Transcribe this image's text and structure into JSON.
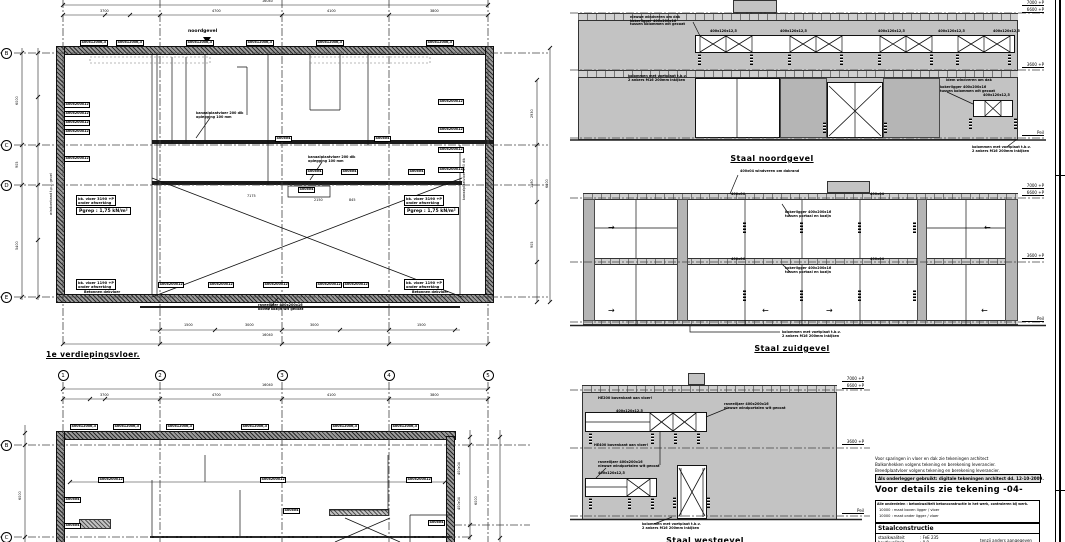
{
  "titles": {
    "plan1": "1e verdiepingsvloer.",
    "elev1": "Staal noordgevel",
    "elev2": "Staal zuidgevel",
    "elev3": "Staal westgevel",
    "marker": "noordgevel"
  },
  "grid": {
    "cols": [
      "1",
      "2",
      "3",
      "4",
      "5"
    ],
    "rows1": [
      "B",
      "C",
      "D",
      "E"
    ],
    "rows2": [
      "B",
      "C"
    ]
  },
  "levels": [
    "7000 +P",
    "6600 +P",
    "3600 +P",
    "Peil"
  ],
  "load": {
    "bk1": "bk. vloer 3190 +P",
    "bk2": "onder afwerking",
    "pgrep": "Pgrep : 1,75 kN/m²",
    "bklow": "bk. vloer 1190 +P"
  },
  "notes": {
    "line1": "Voor sparingen in vloer en dak zie tekeningen architect",
    "line2": "Balkonhekken volgens tekening en berekening leverancier.",
    "line3": "Breedplaatvloer volgens tekening en berekening leverancier.",
    "boxed": "Als onderlegger gebruikt: digitale tekeningen architect dd. 12-10-2009.",
    "detail": "Voor details zie tekening -04-",
    "legend_title": "Alle onderdelen : betonkwaliteit betonconstructie in het werk, controleren bij werk.",
    "legend1": "10000  : maat boven ligger / vloer",
    "legend2": "10000  : maat onder ligger / vloer",
    "table_title": "Staalconstructie",
    "r1_label": "staalkwaliteit",
    "r1_value": ":  FeE 235",
    "r2_label": "boutkwaliteit",
    "r2_value": ":  8.8",
    "r2_note": "tenzij anders aangegeven"
  },
  "ann": {
    "plan1": [
      {
        "t": "16040",
        "x": 262,
        "y": 0,
        "c": "dim"
      },
      {
        "t": "3700",
        "x": 100,
        "y": 10,
        "c": "dim"
      },
      {
        "t": "4700",
        "x": 212,
        "y": 10,
        "c": "dim"
      },
      {
        "t": "4100",
        "x": 327,
        "y": 10,
        "c": "dim"
      },
      {
        "t": "3800",
        "x": 430,
        "y": 10,
        "c": "dim"
      },
      {
        "t": "400x120x6,3",
        "x": 80,
        "y": 40,
        "c": "box"
      },
      {
        "t": "400x120x6,3",
        "x": 116,
        "y": 40,
        "c": "box"
      },
      {
        "t": "400x120x6,3",
        "x": 186,
        "y": 40,
        "c": "box"
      },
      {
        "t": "400x120x6,3",
        "x": 246,
        "y": 40,
        "c": "box"
      },
      {
        "t": "400x120x6,3",
        "x": 316,
        "y": 40,
        "c": "box"
      },
      {
        "t": "400x120x6,3",
        "x": 426,
        "y": 40,
        "c": "box"
      },
      {
        "t": "400x200x12",
        "x": 64,
        "y": 102,
        "c": "box"
      },
      {
        "t": "400x200x12",
        "x": 64,
        "y": 111,
        "c": "box"
      },
      {
        "t": "400x200x12",
        "x": 64,
        "y": 120,
        "c": "box"
      },
      {
        "t": "400x200x12",
        "x": 64,
        "y": 129,
        "c": "box"
      },
      {
        "t": "400x200x12",
        "x": 64,
        "y": 156,
        "c": "box"
      },
      {
        "t": "kanaalplaatvloer 200 dik\noplegging 100 mm",
        "x": 196,
        "y": 112,
        "c": "ldr"
      },
      {
        "t": "kanaalplaatvloer 200 dik\noplegging 100 mm",
        "x": 308,
        "y": 156,
        "c": "ldr"
      },
      {
        "t": "400x04",
        "x": 275,
        "y": 136,
        "c": "box"
      },
      {
        "t": "400x04",
        "x": 374,
        "y": 136,
        "c": "box"
      },
      {
        "t": "400x04",
        "x": 306,
        "y": 169,
        "c": "box"
      },
      {
        "t": "400x04",
        "x": 341,
        "y": 169,
        "c": "box"
      },
      {
        "t": "400x04",
        "x": 408,
        "y": 169,
        "c": "box"
      },
      {
        "t": "400x04",
        "x": 298,
        "y": 187,
        "c": "box"
      },
      {
        "t": "7175",
        "x": 247,
        "y": 195,
        "c": "dim"
      },
      {
        "t": "2150",
        "x": 314,
        "y": 199,
        "c": "dim"
      },
      {
        "t": "845",
        "x": 349,
        "y": 199,
        "c": "dim"
      },
      {
        "t": "400x200x12",
        "x": 438,
        "y": 99,
        "c": "box"
      },
      {
        "t": "400x200x12",
        "x": 438,
        "y": 127,
        "c": "box"
      },
      {
        "t": "400x200x12",
        "x": 438,
        "y": 147,
        "c": "box"
      },
      {
        "t": "400x200x12",
        "x": 438,
        "y": 167,
        "c": "box"
      },
      {
        "t": "windverband t.p.v. gevel",
        "x": 50,
        "y": 215,
        "c": "vtxt"
      },
      {
        "t": "kanaalplaatvloer 200 dik",
        "x": 463,
        "y": 200,
        "c": "vtxt"
      },
      {
        "t": "400x200x12",
        "x": 158,
        "y": 282,
        "c": "box"
      },
      {
        "t": "400x200x12",
        "x": 208,
        "y": 282,
        "c": "box"
      },
      {
        "t": "400x200x12",
        "x": 263,
        "y": 282,
        "c": "box"
      },
      {
        "t": "400x200x12",
        "x": 316,
        "y": 282,
        "c": "box"
      },
      {
        "t": "400x200x12",
        "x": 343,
        "y": 282,
        "c": "box"
      },
      {
        "t": "raveelijzer 400x200x16\nboven kozijn wit gecoat",
        "x": 258,
        "y": 304,
        "c": "ldr"
      },
      {
        "t": "Betonnen dekvloer",
        "x": 84,
        "y": 291,
        "c": "blk"
      },
      {
        "t": "Betonnen dekvloer",
        "x": 412,
        "y": 291,
        "c": "blk"
      },
      {
        "t": "1500",
        "x": 184,
        "y": 324,
        "c": "dim"
      },
      {
        "t": "3000",
        "x": 245,
        "y": 324,
        "c": "dim"
      },
      {
        "t": "3000",
        "x": 310,
        "y": 324,
        "c": "dim"
      },
      {
        "t": "1500",
        "x": 417,
        "y": 324,
        "c": "dim"
      },
      {
        "t": "16040",
        "x": 262,
        "y": 334,
        "c": "dim"
      },
      {
        "t": "6000",
        "x": 16,
        "y": 105,
        "c": "vtxt"
      },
      {
        "t": "905",
        "x": 16,
        "y": 168,
        "c": "vtxt"
      },
      {
        "t": "5400",
        "x": 16,
        "y": 250,
        "c": "vtxt"
      },
      {
        "t": "2930",
        "x": 531,
        "y": 118,
        "c": "vtxt"
      },
      {
        "t": "1580",
        "x": 531,
        "y": 188,
        "c": "vtxt"
      },
      {
        "t": "905",
        "x": 531,
        "y": 248,
        "c": "vtxt"
      },
      {
        "t": "6000",
        "x": 546,
        "y": 188,
        "c": "vtxt"
      }
    ],
    "plan2": [
      {
        "t": "16040",
        "x": 262,
        "y": 384,
        "c": "dim"
      },
      {
        "t": "3700",
        "x": 100,
        "y": 394,
        "c": "dim"
      },
      {
        "t": "4700",
        "x": 212,
        "y": 394,
        "c": "dim"
      },
      {
        "t": "4100",
        "x": 327,
        "y": 394,
        "c": "dim"
      },
      {
        "t": "3800",
        "x": 430,
        "y": 394,
        "c": "dim"
      },
      {
        "t": "400x120x6,3",
        "x": 70,
        "y": 424,
        "c": "box"
      },
      {
        "t": "400x120x6,3",
        "x": 113,
        "y": 424,
        "c": "box"
      },
      {
        "t": "400x120x6,3",
        "x": 166,
        "y": 424,
        "c": "box"
      },
      {
        "t": "400x120x6,3",
        "x": 241,
        "y": 424,
        "c": "box"
      },
      {
        "t": "400x120x6,3",
        "x": 331,
        "y": 424,
        "c": "box"
      },
      {
        "t": "400x120x6,3",
        "x": 391,
        "y": 424,
        "c": "box"
      },
      {
        "t": "400x200x12",
        "x": 98,
        "y": 477,
        "c": "box"
      },
      {
        "t": "400x200x12",
        "x": 260,
        "y": 477,
        "c": "box"
      },
      {
        "t": "400x200x12",
        "x": 406,
        "y": 477,
        "c": "box"
      },
      {
        "t": "400x04",
        "x": 64,
        "y": 497,
        "c": "box"
      },
      {
        "t": "400x04",
        "x": 64,
        "y": 523,
        "c": "box"
      },
      {
        "t": "400x04",
        "x": 283,
        "y": 508,
        "c": "box"
      },
      {
        "t": "400x04",
        "x": 428,
        "y": 520,
        "c": "box"
      },
      {
        "t": "6000",
        "x": 19,
        "y": 500,
        "c": "vtxt"
      },
      {
        "t": "400x04",
        "x": 458,
        "y": 475,
        "c": "vtxt"
      },
      {
        "t": "400x04",
        "x": 458,
        "y": 510,
        "c": "vtxt"
      },
      {
        "t": "6000",
        "x": 475,
        "y": 505,
        "c": "vtxt"
      }
    ],
    "elev1": [
      {
        "t": "nieuwe windveren om dak\nkokerligger 400x200x16\ntussen kolommen wit gecoat",
        "x": 630,
        "y": 16,
        "c": "ldr"
      },
      {
        "t": "400x120x12,5",
        "x": 710,
        "y": 30,
        "c": "blk"
      },
      {
        "t": "400x120x12,5",
        "x": 780,
        "y": 30,
        "c": "blk"
      },
      {
        "t": "400x120x12,5",
        "x": 878,
        "y": 30,
        "c": "blk"
      },
      {
        "t": "400x120x12,5",
        "x": 938,
        "y": 30,
        "c": "blk"
      },
      {
        "t": "400x120x12,5",
        "x": 993,
        "y": 30,
        "c": "blk"
      },
      {
        "t": "kolommen met voetplaat t.b.v.\n2 ankers M16 200mm inkijken",
        "x": 628,
        "y": 75,
        "c": "ldr"
      },
      {
        "t": "idem windveren om dak",
        "x": 946,
        "y": 79,
        "c": "ldr"
      },
      {
        "t": "kokerligger 400x200x16\ntussen kolommen wit gecoat",
        "x": 940,
        "y": 86,
        "c": "ldr"
      },
      {
        "t": "400x120x12,5",
        "x": 983,
        "y": 94,
        "c": "blk"
      },
      {
        "t": "kolommen met voetplaat t.b.v.\n2 ankers M16 200mm inkijken",
        "x": 972,
        "y": 146,
        "c": "ldr"
      }
    ],
    "elev2": [
      {
        "t": "400x04  windveren om dakrand",
        "x": 740,
        "y": 170,
        "c": "ldr"
      },
      {
        "t": "400x04",
        "x": 731,
        "y": 193,
        "c": "blk"
      },
      {
        "t": "400x04",
        "x": 870,
        "y": 193,
        "c": "blk"
      },
      {
        "t": "kokerligger 400x200x16\ntussen portaal en kozijn",
        "x": 785,
        "y": 211,
        "c": "ldr"
      },
      {
        "t": "400x04",
        "x": 731,
        "y": 258,
        "c": "blk"
      },
      {
        "t": "400x04",
        "x": 870,
        "y": 258,
        "c": "blk"
      },
      {
        "t": "kokerligger 400x200x16\ntussen portaal en kozijn",
        "x": 785,
        "y": 267,
        "c": "ldr"
      },
      {
        "t": "kolommen met voetplaat t.b.v.\n2 ankers M16 200mm inkijken",
        "x": 782,
        "y": 331,
        "c": "ldr"
      },
      {
        "t": "→",
        "x": 608,
        "y": 224,
        "c": "arrow"
      },
      {
        "t": "←",
        "x": 984,
        "y": 224,
        "c": "arrow"
      },
      {
        "t": "→",
        "x": 608,
        "y": 307,
        "c": "arrow"
      },
      {
        "t": "←",
        "x": 762,
        "y": 307,
        "c": "arrow"
      },
      {
        "t": "→",
        "x": 826,
        "y": 307,
        "c": "arrow"
      },
      {
        "t": "←",
        "x": 981,
        "y": 307,
        "c": "arrow"
      }
    ],
    "elev3": [
      {
        "t": "HE200 bovenkant aan vloer!",
        "x": 598,
        "y": 397,
        "c": "blk"
      },
      {
        "t": "400x120x12,5",
        "x": 616,
        "y": 410,
        "c": "blk"
      },
      {
        "t": "raveelijzer 400x200x16\nnieuwe windportalen wit gecoat",
        "x": 724,
        "y": 403,
        "c": "ldr"
      },
      {
        "t": "HE400 bovenkant aan vloer!",
        "x": 594,
        "y": 444,
        "c": "blk"
      },
      {
        "t": "raveelijzer 400x200x16\nnieuwe windportalen wit gecoat",
        "x": 598,
        "y": 461,
        "c": "ldr"
      },
      {
        "t": "400x120x12,5",
        "x": 598,
        "y": 472,
        "c": "blk"
      },
      {
        "t": "kolommen met voetplaat t.b.v.\n2 ankers M16 200mm inkijken",
        "x": 642,
        "y": 523,
        "c": "ldr"
      }
    ]
  }
}
